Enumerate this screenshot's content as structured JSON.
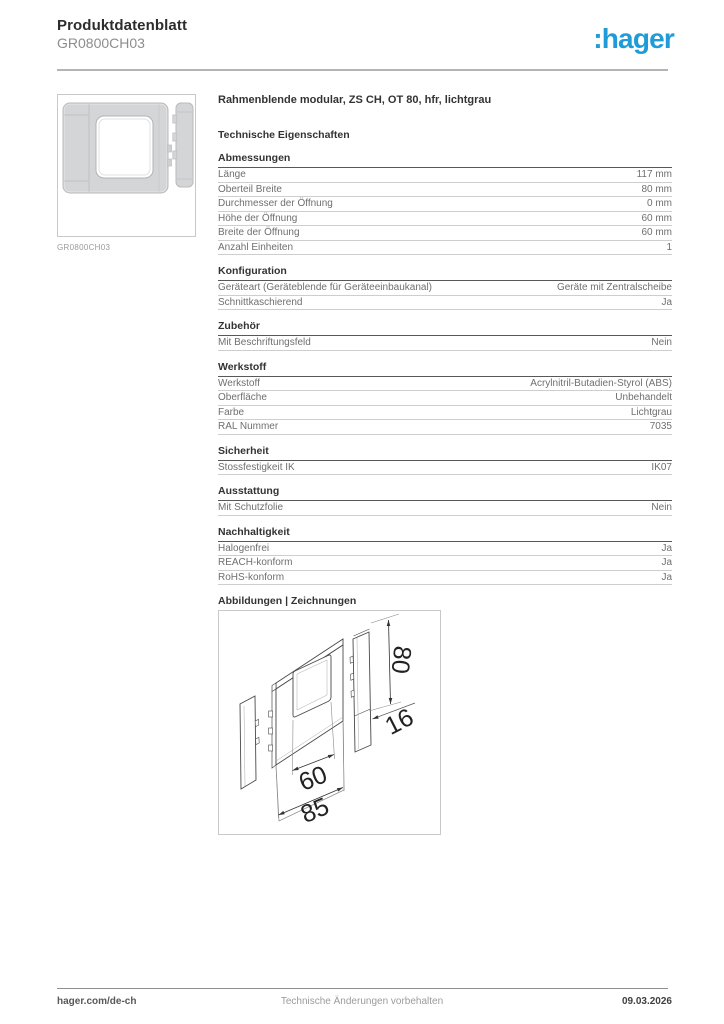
{
  "header": {
    "title": "Produktdatenblatt",
    "subtitle": "GR0800CH03",
    "logo_text": ":hager",
    "logo_color": "#1f9cd8"
  },
  "product": {
    "title": "Rahmenblende modular, ZS CH, OT 80, hfr, lichtgrau",
    "image_caption": "GR0800CH03"
  },
  "tech_heading": "Technische Eigenschaften",
  "sections": [
    {
      "title": "Abmessungen",
      "rows": [
        {
          "label": "Länge",
          "value": "117 mm"
        },
        {
          "label": "Oberteil Breite",
          "value": "80 mm"
        },
        {
          "label": "Durchmesser der Öffnung",
          "value": "0 mm"
        },
        {
          "label": "Höhe der Öffnung",
          "value": "60 mm"
        },
        {
          "label": "Breite der Öffnung",
          "value": "60 mm"
        },
        {
          "label": "Anzahl Einheiten",
          "value": "1"
        }
      ]
    },
    {
      "title": "Konfiguration",
      "rows": [
        {
          "label": "Geräteart (Geräteblende für Geräteeinbaukanal)",
          "value": "Geräte mit Zentralscheibe"
        },
        {
          "label": "Schnittkaschierend",
          "value": "Ja"
        }
      ]
    },
    {
      "title": "Zubehör",
      "rows": [
        {
          "label": "Mit Beschriftungsfeld",
          "value": "Nein"
        }
      ]
    },
    {
      "title": "Werkstoff",
      "rows": [
        {
          "label": "Werkstoff",
          "value": "Acrylnitril-Butadien-Styrol (ABS)"
        },
        {
          "label": "Oberfläche",
          "value": "Unbehandelt"
        },
        {
          "label": "Farbe",
          "value": "Lichtgrau"
        },
        {
          "label": "RAL Nummer",
          "value": "7035"
        }
      ]
    },
    {
      "title": "Sicherheit",
      "rows": [
        {
          "label": "Stossfestigkeit IK",
          "value": "IK07"
        }
      ]
    },
    {
      "title": "Ausstattung",
      "rows": [
        {
          "label": "Mit Schutzfolie",
          "value": "Nein"
        }
      ]
    },
    {
      "title": "Nachhaltigkeit",
      "rows": [
        {
          "label": "Halogenfrei",
          "value": "Ja"
        },
        {
          "label": "REACH-konform",
          "value": "Ja"
        },
        {
          "label": "RoHS-konform",
          "value": "Ja"
        }
      ]
    }
  ],
  "drawings_heading": "Abbildungen | Zeichnungen",
  "drawing": {
    "dim_height": "80",
    "dim_depth": "16",
    "dim_opening_width": "60",
    "dim_width": "85"
  },
  "footer": {
    "website": "hager.com/de-ch",
    "notice": "Technische Änderungen vorbehalten",
    "date": "09.03.2026"
  }
}
